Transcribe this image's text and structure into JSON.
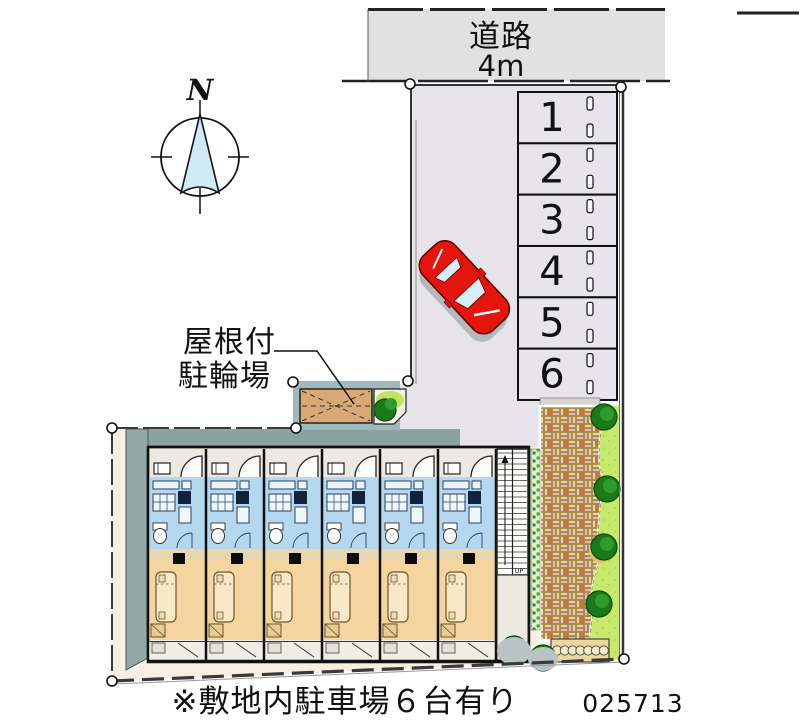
{
  "road": {
    "label": "道路",
    "width_label": "4m"
  },
  "compass": {
    "label": "N"
  },
  "parking": {
    "stalls": [
      "1",
      "2",
      "3",
      "4",
      "5",
      "6"
    ]
  },
  "bicycle_parking_label": {
    "line1": "屋根付",
    "line2": "駐輪場"
  },
  "building": {
    "unit_count": 6,
    "stair_up": "UP"
  },
  "site_note": "※敷地内駐車場６台有り",
  "plan_number": "025713",
  "colors": {
    "road_fill": "#e1e1e1",
    "pavement": "#e6e4e9",
    "stall_fill": "#e7e5e9",
    "unit_blue": "#b5d7ef",
    "unit_tan": "#f4d49f",
    "corridor": "#ece9e2",
    "cream": "#f6efe2",
    "teal_wall": "#8ba2a2",
    "roof_teal": "#9fb9bd",
    "bike_floor": "#d9a877",
    "lawn": "#c6e96b",
    "bush_green": "#1a7a1a",
    "car_red": "#e3150d",
    "compass_needle": "#cfe9f6"
  }
}
